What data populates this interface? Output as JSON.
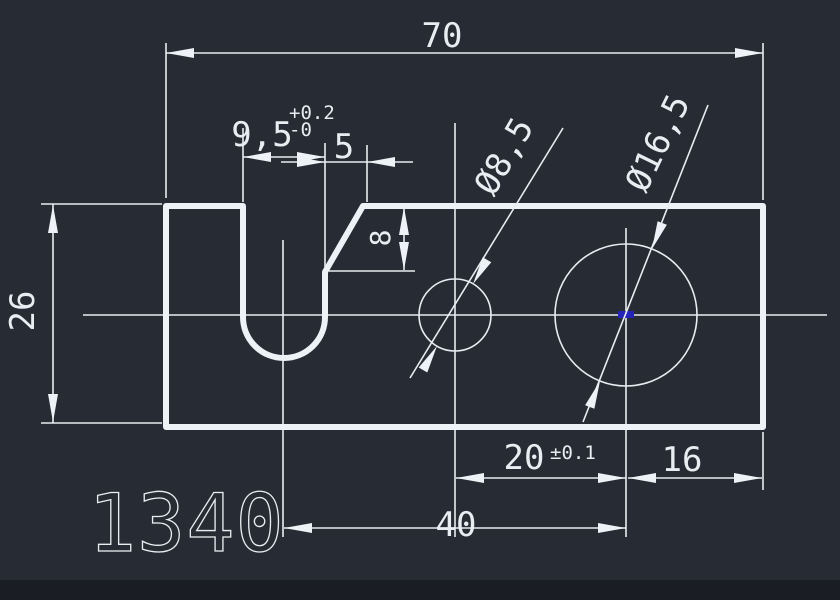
{
  "canvas": {
    "background": "#262b34",
    "bottom_strip_color": "#1a1d23",
    "line_color": "#e9ecf0",
    "grip_color": "#2323b8"
  },
  "part_label": "1340",
  "dimensions": {
    "overall_width": {
      "value": "70"
    },
    "overall_height": {
      "value": "26"
    },
    "slot_width": {
      "value": "9,5",
      "tol_upper": "+0.2",
      "tol_lower": "-0"
    },
    "chamfer_width": {
      "value": "5"
    },
    "chamfer_depth": {
      "value": "8"
    },
    "small_hole_diameter": {
      "value": "Ø8,5"
    },
    "large_hole_diameter": {
      "value": "Ø16,5"
    },
    "hole_spacing": {
      "value": "20",
      "tol": "±0.1"
    },
    "hole_to_right_edge": {
      "value": "16"
    },
    "slot_to_hole": {
      "value": "40"
    }
  }
}
